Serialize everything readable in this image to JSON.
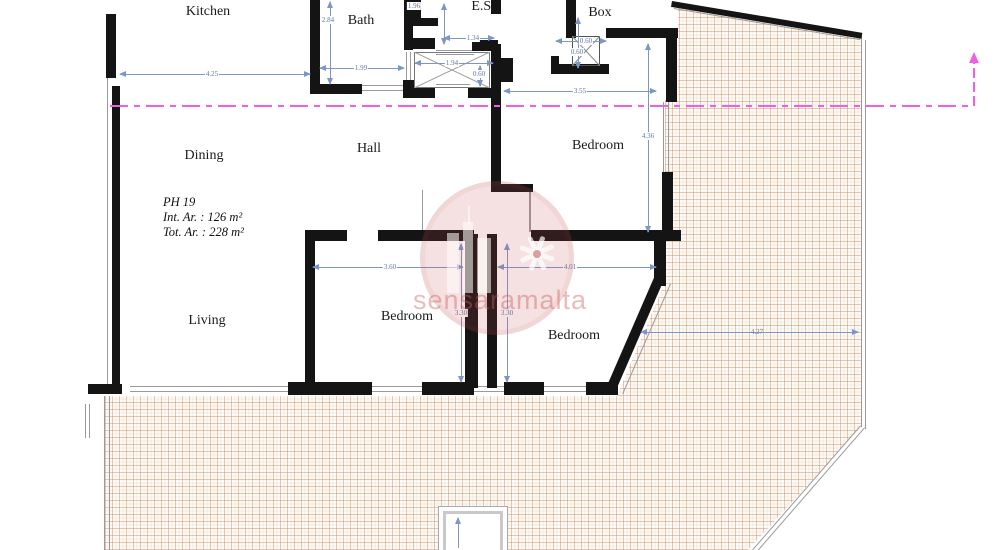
{
  "title": "Apartment PH 19 floor plan",
  "rooms": {
    "kitchen": "Kitchen",
    "bath": "Bath",
    "es": "E.S.",
    "box": "Box",
    "dining": "Dining",
    "hall": "Hall",
    "bedroom_ne": "Bedroom",
    "living": "Living",
    "bedroom_s": "Bedroom",
    "bedroom_se": "Bedroom"
  },
  "info": {
    "unit": "PH 19",
    "int_area": "Int. Ar. : 126 m²",
    "tot_area": "Tot. Ar. : 228 m²"
  },
  "dims": {
    "kitchen_w": "4.25",
    "bath_h": "2.84",
    "bath_w": "1.99",
    "es_h": "1.96",
    "es_w": "1.34",
    "stair_w": "1.94",
    "stair_d": "0.60",
    "shaft_w": "0.60",
    "shaft_h": "0.60",
    "hall_w": "3.55",
    "bedne_h": "4.36",
    "beds_w": "3.60",
    "bedse_w": "4.01",
    "beds_h": "3.30",
    "bedse_h": "3.30",
    "terrace_w": "4.27"
  },
  "watermark": {
    "text": "sensaramalta"
  },
  "colors": {
    "wall": "#141414",
    "dimension": "#7d96c8",
    "section_line": "#ee5fe1",
    "tile_line": "#c4763f",
    "watermark": "#c64c4c"
  }
}
